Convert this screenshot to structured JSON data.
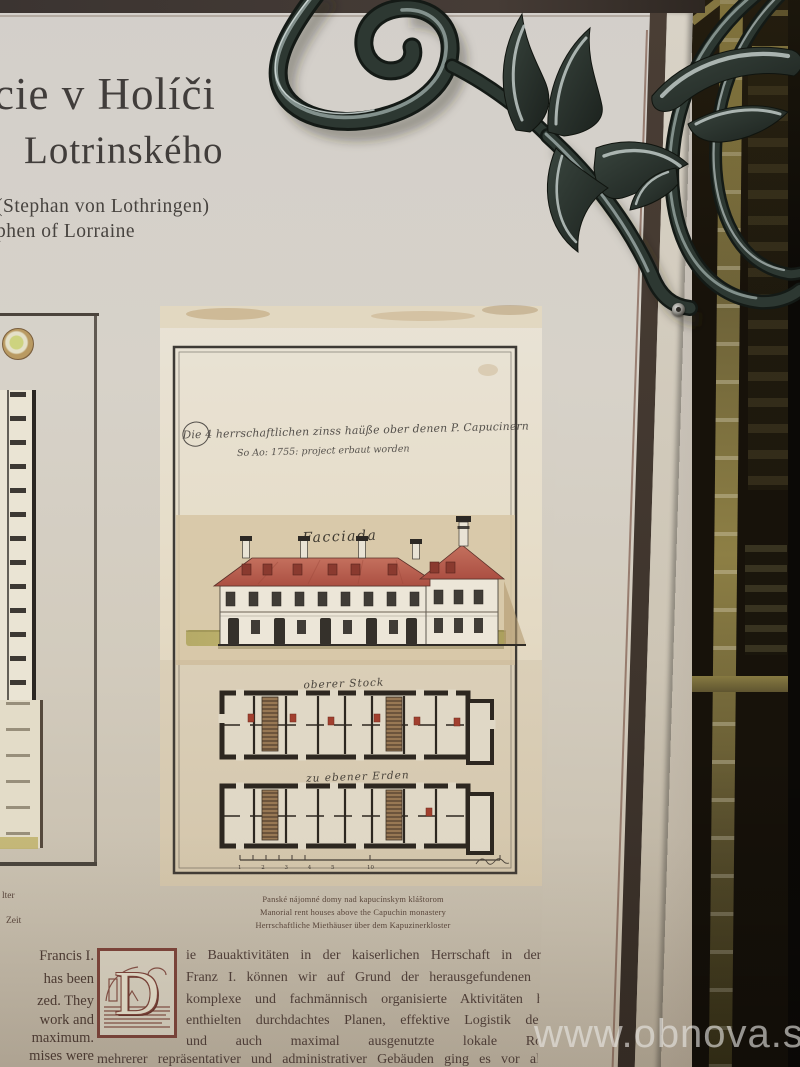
{
  "header": {
    "title_line1": "cie v Holíči",
    "title_line2": "Lotrinského",
    "subtitle_line1": "(Stephan von Lothringen)",
    "subtitle_line2": "phen of Lorraine"
  },
  "main_drawing": {
    "inscription_line1": "Die 4 herrschaftlichen zinss haüße ober denen P. Capucinern",
    "inscription_line2": "So Ao: 1755: project erbaut worden",
    "facade_label": "Facciada",
    "upper_plan_label": "oberer Stock",
    "ground_plan_label": "zu ebener Erden",
    "scale_numbers": "1 2 3 4 5",
    "scale_number_far": "10",
    "captions": [
      "Panské nájomné domy nad kapucínskym kláštorom",
      "Manorial rent houses above the Capuchin monastery",
      "Herrschaftliche Miethäuser über dem Kapuzinerkloster"
    ]
  },
  "left_column": {
    "caption_fragment_1": "lter",
    "caption_fragment_2": "Zeit",
    "text_fragments": [
      "Francis I.",
      "has been",
      "zed. They",
      "work and",
      "maximum.",
      "mises were"
    ]
  },
  "paragraph": {
    "drop_cap": "D",
    "lines": [
      "ie Bauaktivitäten in der kaiserlichen Herrschaft in der Ära von",
      "Franz I. können wir auf Grund der herausgefundenen Fakten für",
      "komplexe und fachmännisch organisierte Aktivitäten halten. Sie",
      "enthielten durchdachtes Planen, effektive Logistik der Arbeiten",
      "und auch maximal ausgenutzte lokale Rohstoffbasis.",
      "mehrerer repräsentativer und administrativer Gebäuden ging es vor allem um"
    ]
  },
  "watermark_text": "www.obnova.sk",
  "colors": {
    "panel_beige": "#d5d0c7",
    "border_brown": "#463a31",
    "roof_red": "#b45a4b",
    "text_maroon": "#53413a",
    "dropcap_maroon": "#7e453b",
    "iron_dark": "#27302b",
    "iron_highlight": "#c6d0ce",
    "window_gold": "#948549",
    "watermark_gray": "#e9e7e4"
  }
}
